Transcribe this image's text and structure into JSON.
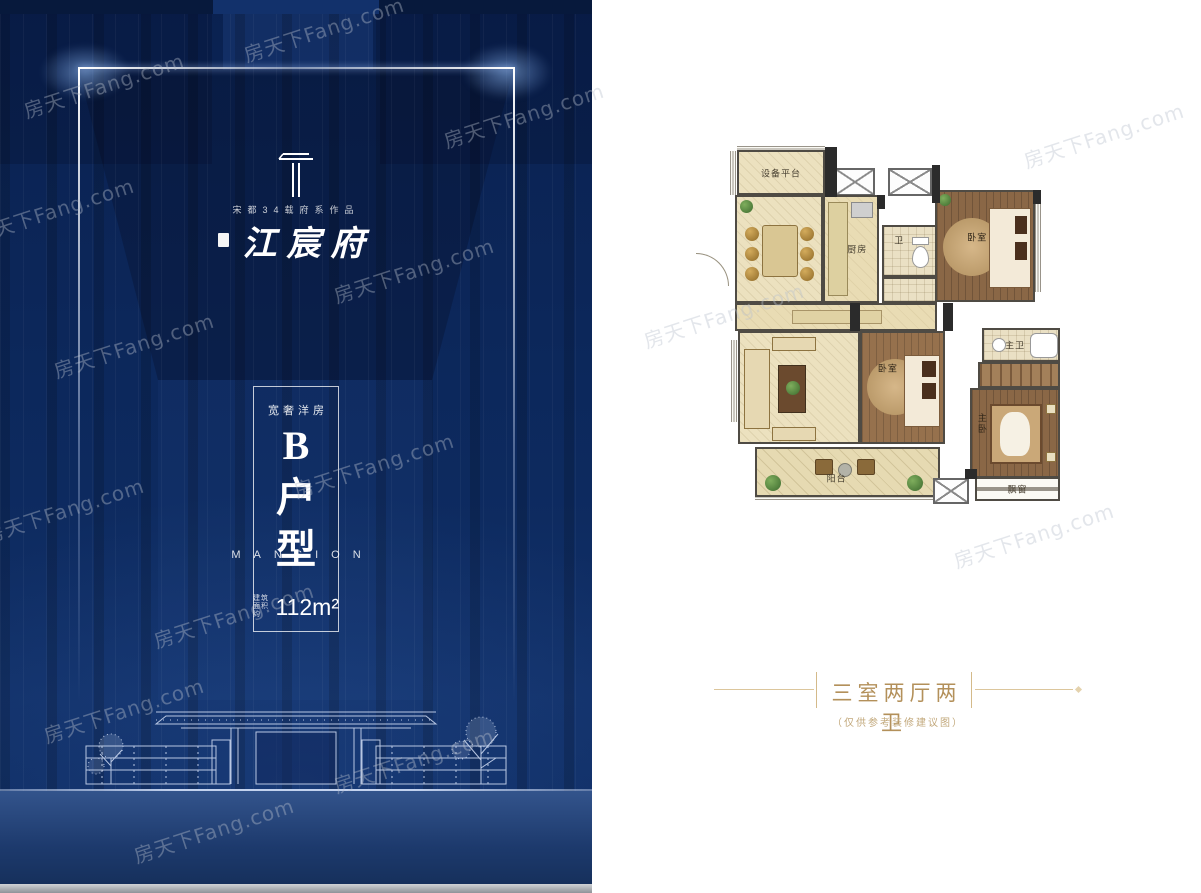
{
  "watermark": {
    "text": "房天下Fang.com"
  },
  "poster": {
    "brand_line": "宋都34载府系作品",
    "project_name": "江宸府",
    "tagline": "宽奢洋房",
    "unit_char_1": "B",
    "unit_char_2": "户",
    "unit_char_3": "型",
    "mansion_label": "MANSION",
    "area_prefix_line1": "建筑",
    "area_prefix_line2": "面积约",
    "area_value": "112m²"
  },
  "floorplan": {
    "rooms": {
      "equipment_platform": "设备平台",
      "kitchen": "厨房",
      "bath": "卫",
      "bedroom_top": "卧室",
      "bedroom_mid": "卧室",
      "master_bedroom": "主卧",
      "master_bath": "主卫",
      "balcony": "阳台",
      "bay_window": "飘窗"
    },
    "title": "三室两厅两卫",
    "note": "（仅供参考装修建议图）"
  },
  "colors": {
    "poster_navy": "#0d2a5f",
    "accent_gold": "#b3905a"
  }
}
